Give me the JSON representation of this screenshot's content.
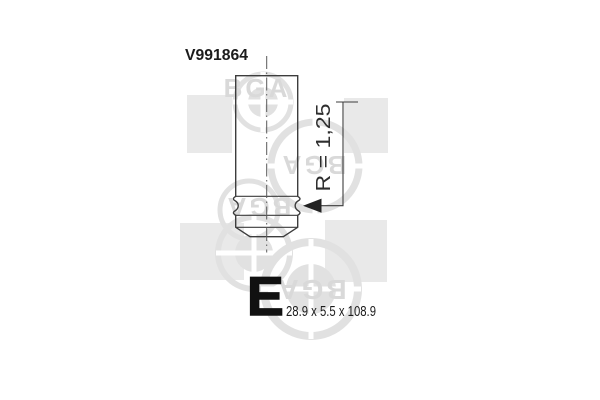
{
  "drawing": {
    "part_number": "V991864",
    "radius_label": "R = 1,25",
    "type_letter": "E",
    "dimensions_label": "28.9 x 5.5 x 108.9"
  },
  "watermark": {
    "brand": "BGA"
  },
  "colors": {
    "line": "#3d3d3d",
    "dark_text": "#1c1c1c",
    "watermark_gray": "#e1e1e1",
    "watermark_square": "#e9e9e9",
    "watermark_text": "#d9d9d9",
    "background": "#ffffff"
  }
}
